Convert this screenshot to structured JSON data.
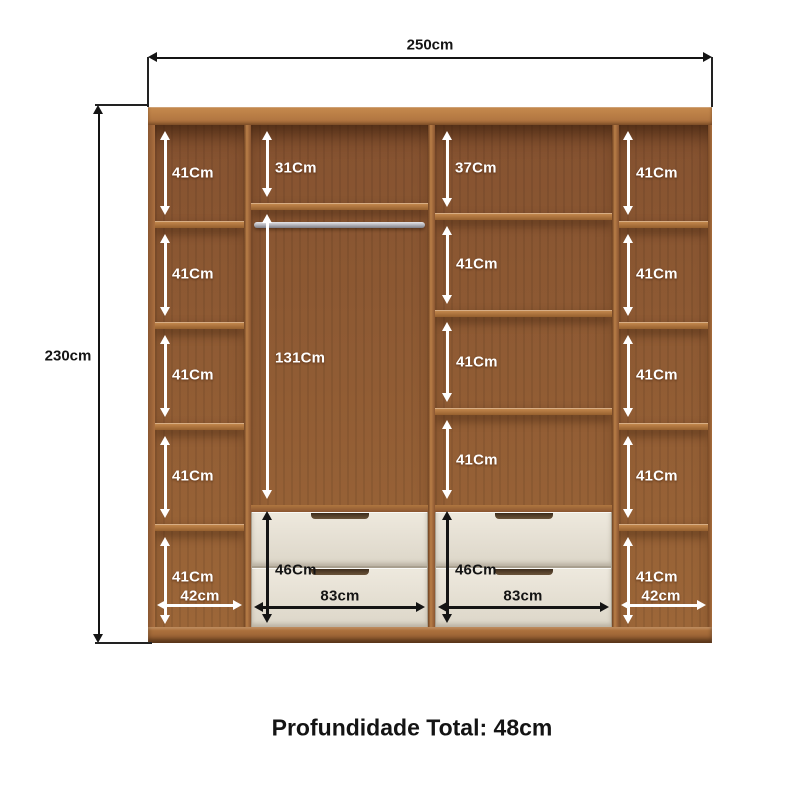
{
  "dimensions": {
    "width_label": "250cm",
    "height_label": "230cm",
    "depth_label": "Profundidade Total: 48cm"
  },
  "left_column": {
    "shelf_labels": [
      "41Cm",
      "41Cm",
      "41Cm",
      "41Cm",
      "41Cm"
    ],
    "width_label": "42cm"
  },
  "hanging_section": {
    "top_label": "31Cm",
    "height_label": "131Cm",
    "drawer_label": "46Cm",
    "width_label": "83cm"
  },
  "shelf_section": {
    "top_label": "37Cm",
    "shelf_labels": [
      "41Cm",
      "41Cm",
      "41Cm"
    ],
    "drawer_label": "46Cm",
    "width_label": "83cm"
  },
  "right_column": {
    "shelf_labels": [
      "41Cm",
      "41Cm",
      "41Cm",
      "41Cm",
      "41Cm"
    ],
    "width_label": "42cm"
  },
  "colors": {
    "wood": "#b5783f",
    "wood_dark": "#8a5630",
    "drawer_front": "#e8e3d7",
    "hanging_rod": "#b9b9bf",
    "dimension_line": "#141414",
    "arrow_white": "#ffffff"
  }
}
